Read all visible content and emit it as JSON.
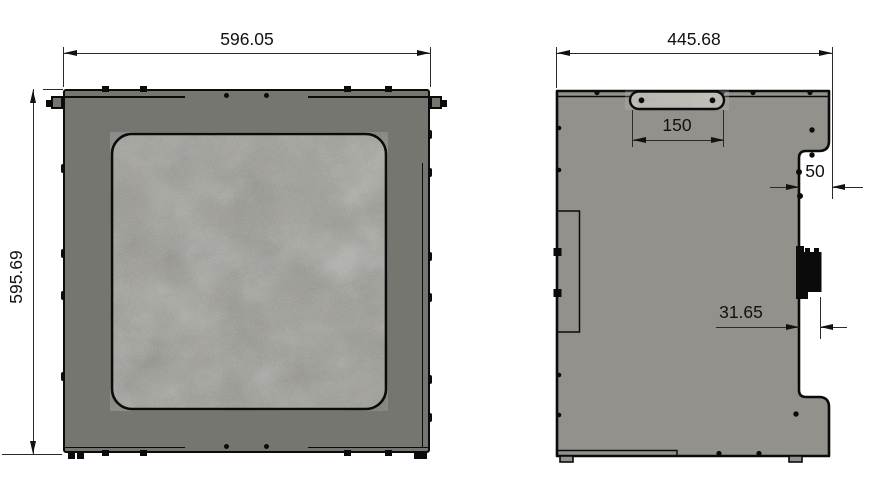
{
  "views": {
    "front": {
      "dim_width": "596.05",
      "dim_height": "595.69"
    },
    "side": {
      "dim_width": "445.68",
      "dim_handle_width": "150",
      "dim_step_depth": "50",
      "dim_connector_offset": "31.65"
    }
  },
  "colors": {
    "background": "#ffffff",
    "front_panel": "#767670",
    "side_panel": "#92918b",
    "window_texture": "#9a9992",
    "handle_texture": "#bdbbb2",
    "outline": "#0b0b0b",
    "dimension_line": "#2a2a2a",
    "dimension_text": "#111111"
  }
}
